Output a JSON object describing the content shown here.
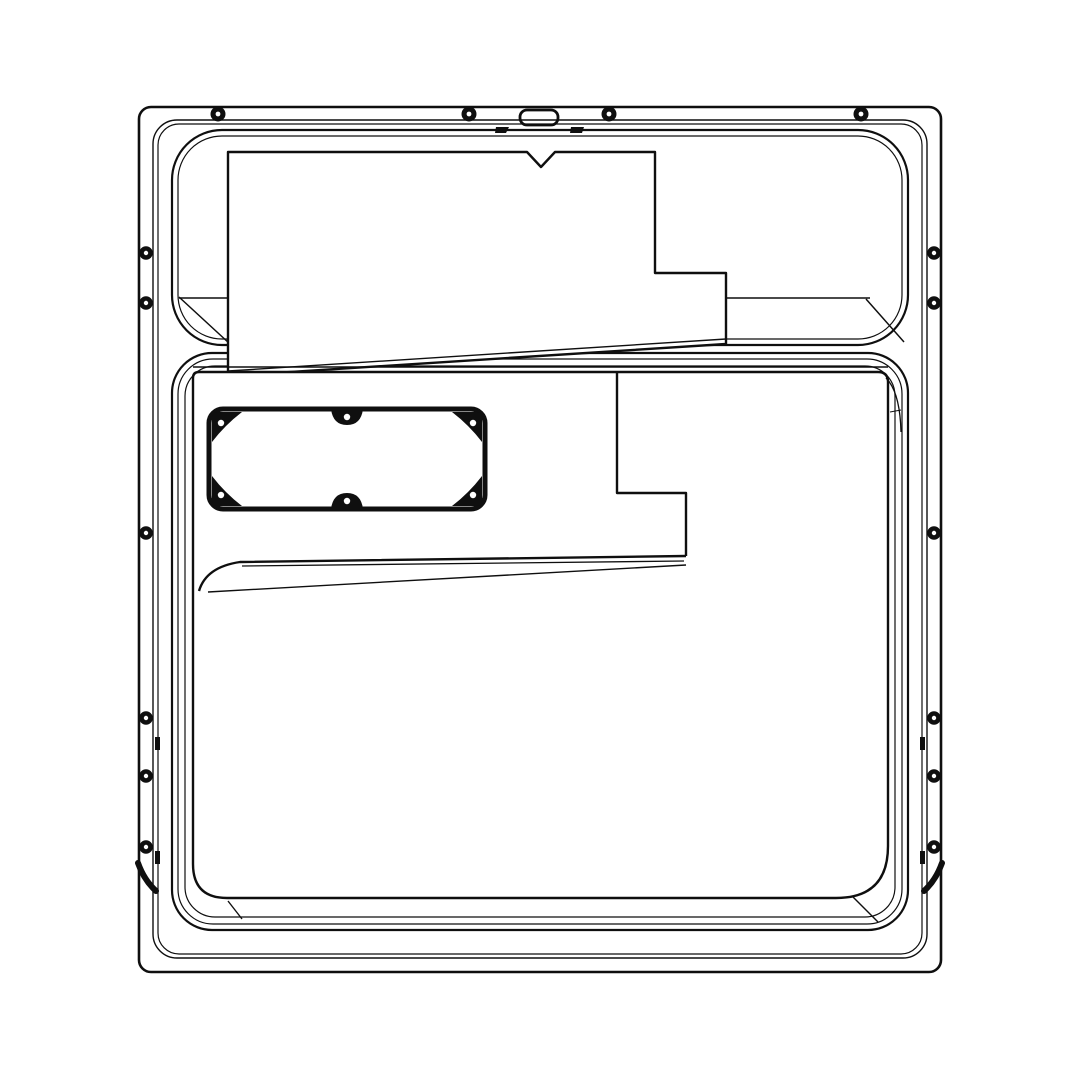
{
  "canvas": {
    "width": 1080,
    "height": 1080,
    "background": "#ffffff",
    "stroke_color": "#0f0f0f",
    "fill_white": "#ffffff"
  },
  "drawing": {
    "title": "appliance-door-inner-panel-line-drawing",
    "primitives": [
      {
        "type": "rect",
        "name": "outer-frame",
        "x": 139,
        "y": 107,
        "w": 802,
        "h": 865,
        "rx": 12,
        "sw": 2.6
      },
      {
        "type": "rect",
        "name": "face-outline-outer",
        "x": 153,
        "y": 120,
        "w": 774,
        "h": 838,
        "rx": 24,
        "sw": 1.4
      },
      {
        "type": "rect",
        "name": "face-outline-inner",
        "x": 158,
        "y": 124,
        "w": 764,
        "h": 830,
        "rx": 21,
        "sw": 1.2
      },
      {
        "type": "rect",
        "name": "upper-pocket-outer",
        "x": 172,
        "y": 130,
        "w": 736,
        "h": 215,
        "rx": 50,
        "sw": 2.2
      },
      {
        "type": "rect",
        "name": "upper-pocket-inner",
        "x": 178,
        "y": 136,
        "w": 724,
        "h": 203,
        "rx": 44,
        "sw": 1.2
      },
      {
        "type": "line",
        "name": "upper-pocket-floor-edge",
        "x1": 179,
        "y1": 298,
        "x2": 870,
        "y2": 298,
        "sw": 1.5
      },
      {
        "type": "line",
        "name": "upper-pocket-wall-left",
        "x1": 179,
        "y1": 297,
        "x2": 230,
        "y2": 344,
        "sw": 1.5
      },
      {
        "type": "line",
        "name": "upper-pocket-wall-right",
        "x1": 866,
        "y1": 299,
        "x2": 904,
        "y2": 342,
        "sw": 1.5
      },
      {
        "type": "rect",
        "name": "lower-pocket-outer",
        "x": 172,
        "y": 353,
        "w": 736,
        "h": 577,
        "rx": 40,
        "sw": 2.2
      },
      {
        "type": "rect",
        "name": "lower-pocket-mid",
        "x": 178,
        "y": 359,
        "w": 724,
        "h": 565,
        "rx": 35,
        "sw": 1.2
      },
      {
        "type": "rect",
        "name": "lower-pocket-inner",
        "x": 185,
        "y": 366,
        "w": 710,
        "h": 551,
        "rx": 30,
        "sw": 1.2
      },
      {
        "type": "path",
        "name": "upper-insulation-panel",
        "d": "M228,152 L527,152 L541,167 L555,152 L655,152 L655,273 L726,273 L726,344 L228,376 Z",
        "sw": 2.4,
        "fill": "#ffffff"
      },
      {
        "type": "line",
        "name": "upper-panel-fold-line",
        "x1": 228,
        "y1": 371,
        "x2": 726,
        "y2": 339,
        "sw": 1.4
      },
      {
        "type": "path",
        "name": "lower-liner-panel",
        "d": "M199,372 L878,372 Q888,372 888,382 L888,846 Q888,898 836,898 L227,898 Q193,898 193,864 L193,378 Q193,372 199,372 Z",
        "sw": 2.4,
        "fill": "#ffffff"
      },
      {
        "type": "line",
        "name": "lower-liner-top-edge",
        "x1": 193,
        "y1": 367,
        "x2": 888,
        "y2": 367,
        "sw": 1.4
      },
      {
        "type": "path",
        "name": "liner-plateau-step",
        "d": "M617,372 L617,493 L686,493 L686,556",
        "sw": 2.4
      },
      {
        "type": "path",
        "name": "liner-shelf-edge",
        "d": "M686,556 L240,562 Q206,567 199,591",
        "sw": 2.4
      },
      {
        "type": "line",
        "name": "liner-shelf-edge-inner",
        "x1": 684,
        "y1": 561,
        "x2": 242,
        "y2": 566,
        "sw": 1.3
      },
      {
        "type": "path",
        "name": "liner-shelf-base",
        "d": "M686,565 L208,592",
        "sw": 1.4
      },
      {
        "type": "path",
        "name": "liner-corner-detail-tr",
        "d": "M886,378 Q900,392 901,432",
        "sw": 1.3
      },
      {
        "type": "line",
        "name": "liner-corner-tick-tr",
        "x1": 890,
        "y1": 412,
        "x2": 901,
        "y2": 410,
        "sw": 1.1
      },
      {
        "type": "line",
        "name": "pocket-corner-diag-bl",
        "x1": 228,
        "y1": 901,
        "x2": 242,
        "y2": 919,
        "sw": 1.4
      },
      {
        "type": "line",
        "name": "pocket-corner-diag-br",
        "x1": 852,
        "y1": 896,
        "x2": 878,
        "y2": 922,
        "sw": 1.4
      },
      {
        "type": "rect",
        "name": "terminal-cover-gasket",
        "x": 209,
        "y": 409,
        "w": 276,
        "h": 100,
        "rx": 14,
        "sw": 5
      },
      {
        "type": "path",
        "name": "gasket-boss-tl",
        "d": "M212,442 L212,417 Q212,412 217,412 L242,412 Q225,425 212,442 Z",
        "fill": "#0f0f0f"
      },
      {
        "type": "path",
        "name": "gasket-boss-tr",
        "d": "M482,442 L482,417 Q482,412 477,412 L452,412 Q469,425 482,442 Z",
        "fill": "#0f0f0f"
      },
      {
        "type": "path",
        "name": "gasket-boss-bl",
        "d": "M212,476 L212,501 Q212,506 217,506 L242,506 Q225,493 212,476 Z",
        "fill": "#0f0f0f"
      },
      {
        "type": "path",
        "name": "gasket-boss-br",
        "d": "M482,476 L482,501 Q482,506 477,506 L452,506 Q469,493 482,476 Z",
        "fill": "#0f0f0f"
      },
      {
        "type": "path",
        "name": "gasket-boss-top-mid",
        "d": "M331,409 Q333,425 347,425 Q361,425 363,409 Z",
        "fill": "#0f0f0f"
      },
      {
        "type": "path",
        "name": "gasket-boss-bottom-mid",
        "d": "M331,509 Q333,493 347,493 Q361,493 363,509 Z",
        "fill": "#0f0f0f"
      },
      {
        "type": "circle",
        "name": "gasket-screw-hole-tl",
        "cx": 221,
        "cy": 423,
        "r": 3.2,
        "fill": "#ffffff"
      },
      {
        "type": "circle",
        "name": "gasket-screw-hole-tr",
        "cx": 473,
        "cy": 423,
        "r": 3.2,
        "fill": "#ffffff"
      },
      {
        "type": "circle",
        "name": "gasket-screw-hole-bl",
        "cx": 221,
        "cy": 495,
        "r": 3.2,
        "fill": "#ffffff"
      },
      {
        "type": "circle",
        "name": "gasket-screw-hole-br",
        "cx": 473,
        "cy": 495,
        "r": 3.2,
        "fill": "#ffffff"
      },
      {
        "type": "circle",
        "name": "gasket-screw-hole-top-mid",
        "cx": 347,
        "cy": 417,
        "r": 3.2,
        "fill": "#ffffff"
      },
      {
        "type": "circle",
        "name": "gasket-screw-hole-bottom-mid",
        "cx": 347,
        "cy": 501,
        "r": 3.2,
        "fill": "#ffffff"
      },
      {
        "type": "rect",
        "name": "latch-slot",
        "x": 520,
        "y": 110,
        "w": 38,
        "h": 15,
        "rx": 7,
        "sw": 2.8
      },
      {
        "type": "path",
        "name": "latch-tick-left",
        "d": "M496,127 L509,127 L506,133 L495,133 Z",
        "fill": "#0f0f0f"
      },
      {
        "type": "path",
        "name": "latch-tick-right",
        "d": "M571,127 L584,127 L582,133 L570,133 Z",
        "fill": "#0f0f0f"
      },
      {
        "type": "rect",
        "name": "side-clip-left-upper",
        "x": 155,
        "y": 737,
        "w": 5,
        "h": 13,
        "fill": "#0f0f0f"
      },
      {
        "type": "rect",
        "name": "side-clip-left-lower",
        "x": 155,
        "y": 851,
        "w": 5,
        "h": 13,
        "fill": "#0f0f0f"
      },
      {
        "type": "rect",
        "name": "side-clip-right-upper",
        "x": 920,
        "y": 737,
        "w": 5,
        "h": 13,
        "fill": "#0f0f0f"
      },
      {
        "type": "rect",
        "name": "side-clip-right-lower",
        "x": 920,
        "y": 851,
        "w": 5,
        "h": 13,
        "fill": "#0f0f0f"
      },
      {
        "type": "path",
        "name": "corner-hook-left",
        "d": "M138,863 Q144,880 156,891",
        "sw": 6,
        "cap": "round"
      },
      {
        "type": "path",
        "name": "corner-hook-right",
        "d": "M942,863 Q936,880 924,891",
        "sw": 6,
        "cap": "round"
      },
      {
        "type": "screw",
        "name": "screw-top-1",
        "cx": 218,
        "cy": 114,
        "r": 7.5,
        "hole": 2.4
      },
      {
        "type": "screw",
        "name": "screw-top-2",
        "cx": 469,
        "cy": 114,
        "r": 7.5,
        "hole": 2.4
      },
      {
        "type": "screw",
        "name": "screw-top-3",
        "cx": 609,
        "cy": 114,
        "r": 7.5,
        "hole": 2.4
      },
      {
        "type": "screw",
        "name": "screw-top-4",
        "cx": 861,
        "cy": 114,
        "r": 7.5,
        "hole": 2.4
      },
      {
        "type": "screw",
        "name": "screw-left-1",
        "cx": 146,
        "cy": 253,
        "r": 6.8,
        "hole": 2.2
      },
      {
        "type": "screw",
        "name": "screw-left-2",
        "cx": 146,
        "cy": 303,
        "r": 6.8,
        "hole": 2.2
      },
      {
        "type": "screw",
        "name": "screw-left-3",
        "cx": 146,
        "cy": 533,
        "r": 6.8,
        "hole": 2.2
      },
      {
        "type": "screw",
        "name": "screw-left-4",
        "cx": 146,
        "cy": 718,
        "r": 6.8,
        "hole": 2.2
      },
      {
        "type": "screw",
        "name": "screw-left-5",
        "cx": 146,
        "cy": 776,
        "r": 6.8,
        "hole": 2.2
      },
      {
        "type": "screw",
        "name": "screw-left-6",
        "cx": 146,
        "cy": 847,
        "r": 6.8,
        "hole": 2.2
      },
      {
        "type": "screw",
        "name": "screw-right-1",
        "cx": 934,
        "cy": 253,
        "r": 6.8,
        "hole": 2.2
      },
      {
        "type": "screw",
        "name": "screw-right-2",
        "cx": 934,
        "cy": 303,
        "r": 6.8,
        "hole": 2.2
      },
      {
        "type": "screw",
        "name": "screw-right-3",
        "cx": 934,
        "cy": 533,
        "r": 6.8,
        "hole": 2.2
      },
      {
        "type": "screw",
        "name": "screw-right-4",
        "cx": 934,
        "cy": 718,
        "r": 6.8,
        "hole": 2.2
      },
      {
        "type": "screw",
        "name": "screw-right-5",
        "cx": 934,
        "cy": 776,
        "r": 6.8,
        "hole": 2.2
      },
      {
        "type": "screw",
        "name": "screw-right-6",
        "cx": 934,
        "cy": 847,
        "r": 6.8,
        "hole": 2.2
      }
    ]
  }
}
